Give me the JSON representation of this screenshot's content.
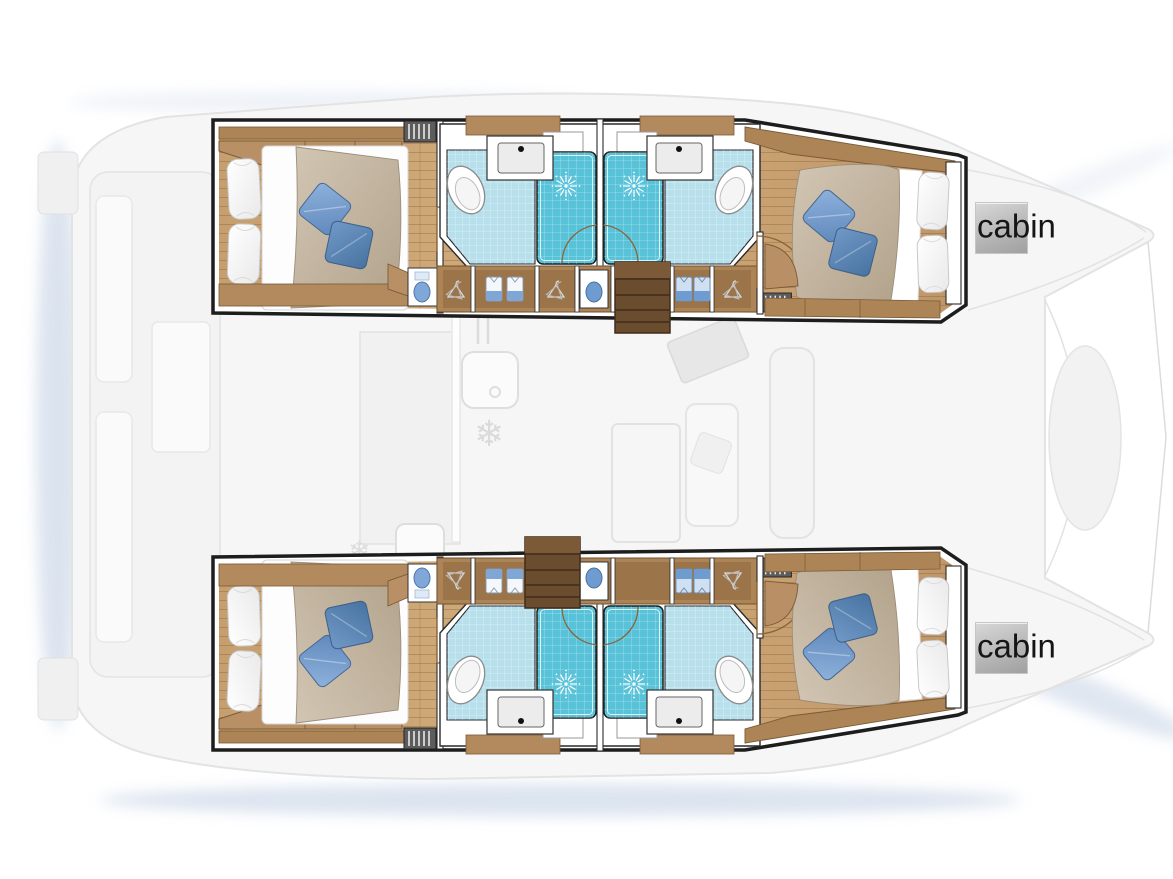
{
  "page": {
    "width": 1173,
    "height": 879,
    "background": "#ffffff"
  },
  "diagram": {
    "kind": "catamaran-yacht-deck-floor-plan",
    "labels": {
      "port_cabin": "cabin",
      "starboard_cabin": "cabin"
    },
    "colors": {
      "outline": "#1d1d1d",
      "wood_floor": "#c9a271",
      "wood_trim": "#ad8455",
      "stairs_wood": "#6a4c2e",
      "bathroom_tile": "#b7e0ec",
      "shower_tile": "#58c2d9",
      "duvet_beige": "#c8baa7",
      "pillow_blue_light": "#82a8d8",
      "pillow_blue_dark": "#5f88bb",
      "ghost_deck": "#f6f6f6",
      "ghost_line": "#e3e3e3",
      "shadow_blue": "#b9c9e0",
      "label_box": "#b5b5b5",
      "label_text": "#151515"
    }
  }
}
